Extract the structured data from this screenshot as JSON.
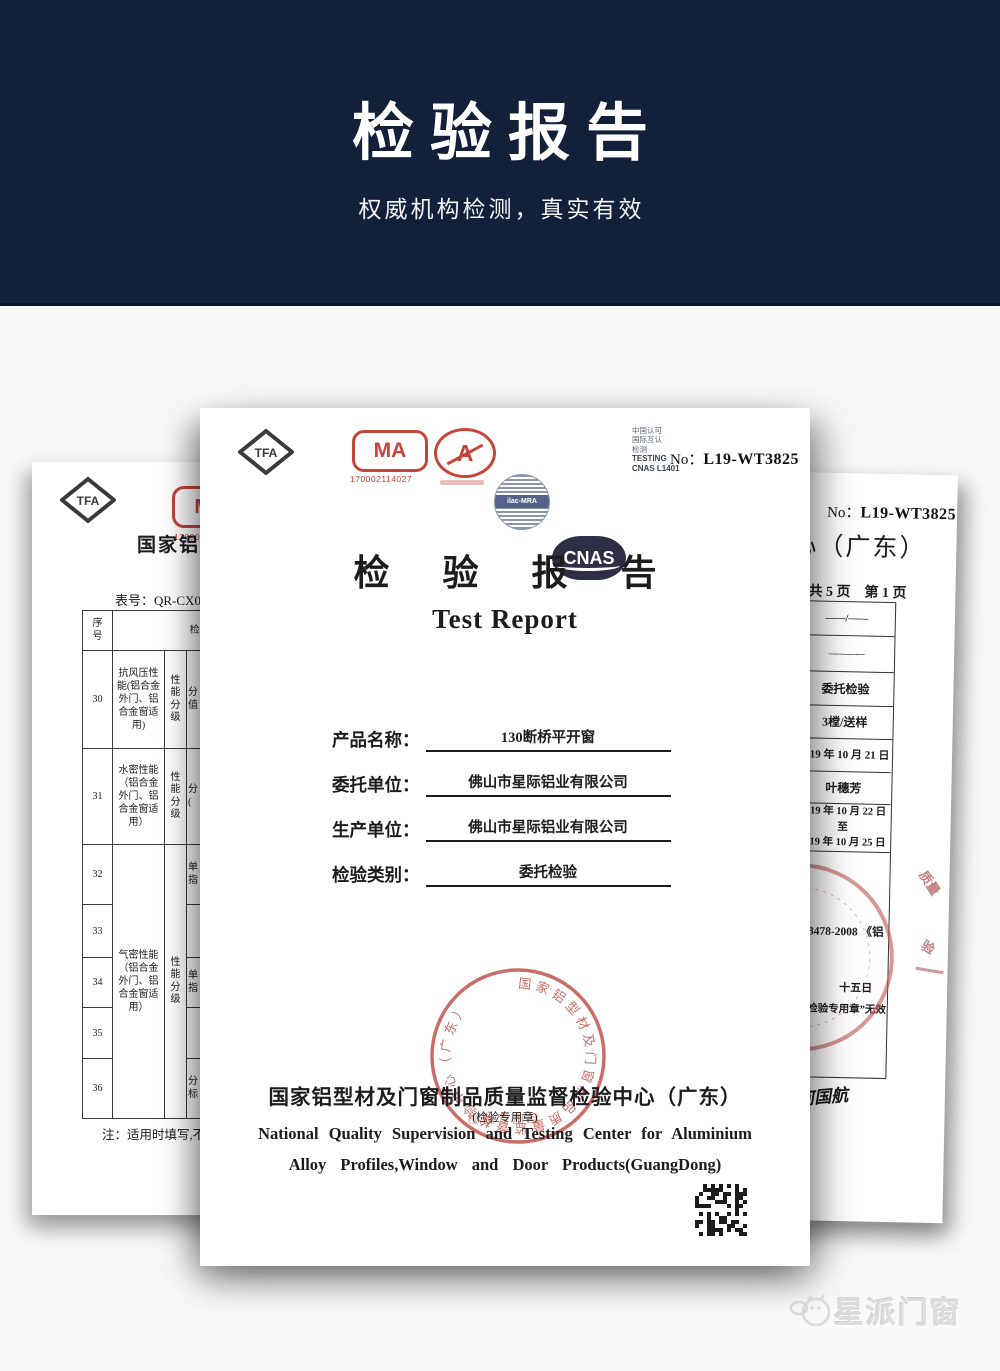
{
  "header": {
    "title": "检验报告",
    "subtitle": "权威机构检测，真实有效"
  },
  "watermark": {
    "brand": "星派门窗"
  },
  "colors": {
    "header_bg": "#12203a",
    "stamp_red": "#c0544e",
    "logo_red": "#c5453a",
    "cnas_navy": "#2e2e46",
    "watermark_gray": "#dcdcdc"
  },
  "center_doc": {
    "logos": {
      "tfa_label": "TFA",
      "cma_label": "MA",
      "cma_number": "170002114027",
      "cal_label": "A",
      "ilac_label": "ilac-MRA",
      "cnas_label": "CNAS",
      "cnas_caption_lines": [
        "中国认可",
        "国际互认",
        "检测"
      ],
      "cnas_testing": "TESTING",
      "cnas_code": "CNAS L1401"
    },
    "report_no_label": "No：",
    "report_no": "L19-WT3825",
    "title_cn": "检 验 报 告",
    "title_en": "Test Report",
    "fields": [
      {
        "label": "产品名称：",
        "value": "130断桥平开窗"
      },
      {
        "label": "委托单位：",
        "value": "佛山市星际铝业有限公司"
      },
      {
        "label": "生产单位：",
        "value": "佛山市星际铝业有限公司"
      },
      {
        "label": "检验类别：",
        "value": "委托检验"
      }
    ],
    "stamp": {
      "ring_text": "国家铝型材及门窗制品质量监督检验中心（广东）",
      "center_text": "检验专用章"
    },
    "issuer_cn": "国家铝型材及门窗制品质量监督检验中心（广东）",
    "seal_note": "(检验专用章)",
    "issuer_en_line1": "National Quality Supervision and Testing Center for Aluminium",
    "issuer_en_line2": "Alloy Profiles,Window and Door Products(GuangDong)"
  },
  "left_doc": {
    "tfa_label": "TFA",
    "cma_label": "MA",
    "cma_number_partial": "17000",
    "heading_partial": "国家铝型",
    "form_no": "表号：QR-CX049",
    "table": {
      "col_no": "序号",
      "col_item": "检 测 项 目",
      "rows": [
        {
          "no": "30",
          "item": "抗风压性能(铝合金外门、铝合金窗适用)",
          "grade": "性能分级",
          "extra": "分值"
        },
        {
          "no": "31",
          "item": "水密性能（铝合金外门、铝合金窗适用）",
          "grade": "性能分级",
          "extra": "分("
        },
        {
          "no": "32",
          "item_merged": "气密性能（铝合金外门、铝合金窗适用）",
          "grade_merged": "性能分级",
          "extra": "单指"
        },
        {
          "no": "33",
          "extra": ""
        },
        {
          "no": "34",
          "extra": "单指"
        },
        {
          "no": "35",
          "extra": ""
        },
        {
          "no": "36",
          "extra": "分标"
        }
      ]
    },
    "note_partial": "注：适用时填写,不"
  },
  "right_doc": {
    "cnas_code_partial": "401",
    "report_no_label": "No：",
    "report_no": "L19-WT3825",
    "heading_partial": "心（广东）",
    "pages": "共 5 页　第 1 页",
    "cells": [
      {
        "text": "——/——"
      },
      {
        "text": "—————"
      },
      {
        "text": "委托检验"
      },
      {
        "text": "3樘/送样"
      },
      {
        "text": "2019 年 10 月 21 日"
      },
      {
        "text": "叶穗芳"
      },
      {
        "text": "2019 年 10 月 22 日至",
        "text2": "2019 年 10 月 25 日"
      }
    ],
    "standard_partial": "/T 8478-2008 《铝",
    "stamp_line_partial": "十五日",
    "invalid_note_partial": "色“检验专用章”无效",
    "signature": "何国航",
    "stamp_fragment1": "质量",
    "stamp_fragment2": "验"
  }
}
